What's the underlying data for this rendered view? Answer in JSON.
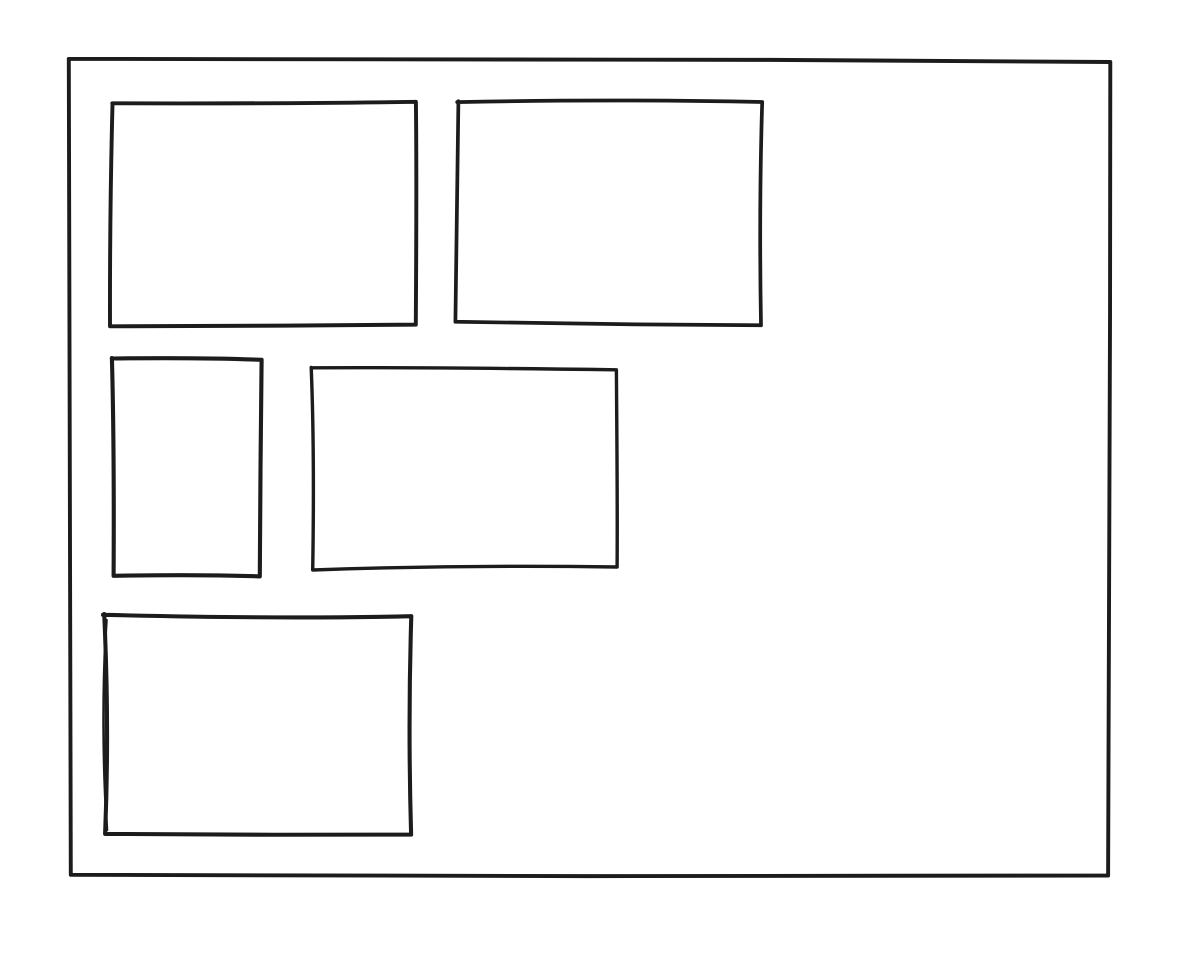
{
  "canvas": {
    "width": 1192,
    "height": 956,
    "background": "#ffffff",
    "stroke_color": "#1c1c1c",
    "stroke_width": 4
  },
  "frame": {
    "id": "outer-frame",
    "x": 71,
    "y": 61,
    "width": 1037,
    "height": 815
  },
  "boxes": [
    {
      "id": "box-top-left",
      "x": 112,
      "y": 104,
      "width": 306,
      "height": 223
    },
    {
      "id": "box-top-right",
      "x": 457,
      "y": 104,
      "width": 306,
      "height": 219
    },
    {
      "id": "box-middle-small",
      "x": 114,
      "y": 359,
      "width": 148,
      "height": 217
    },
    {
      "id": "box-middle-wide",
      "x": 311,
      "y": 369,
      "width": 306,
      "height": 199
    },
    {
      "id": "box-bottom",
      "x": 104,
      "y": 616,
      "width": 306,
      "height": 217
    }
  ]
}
